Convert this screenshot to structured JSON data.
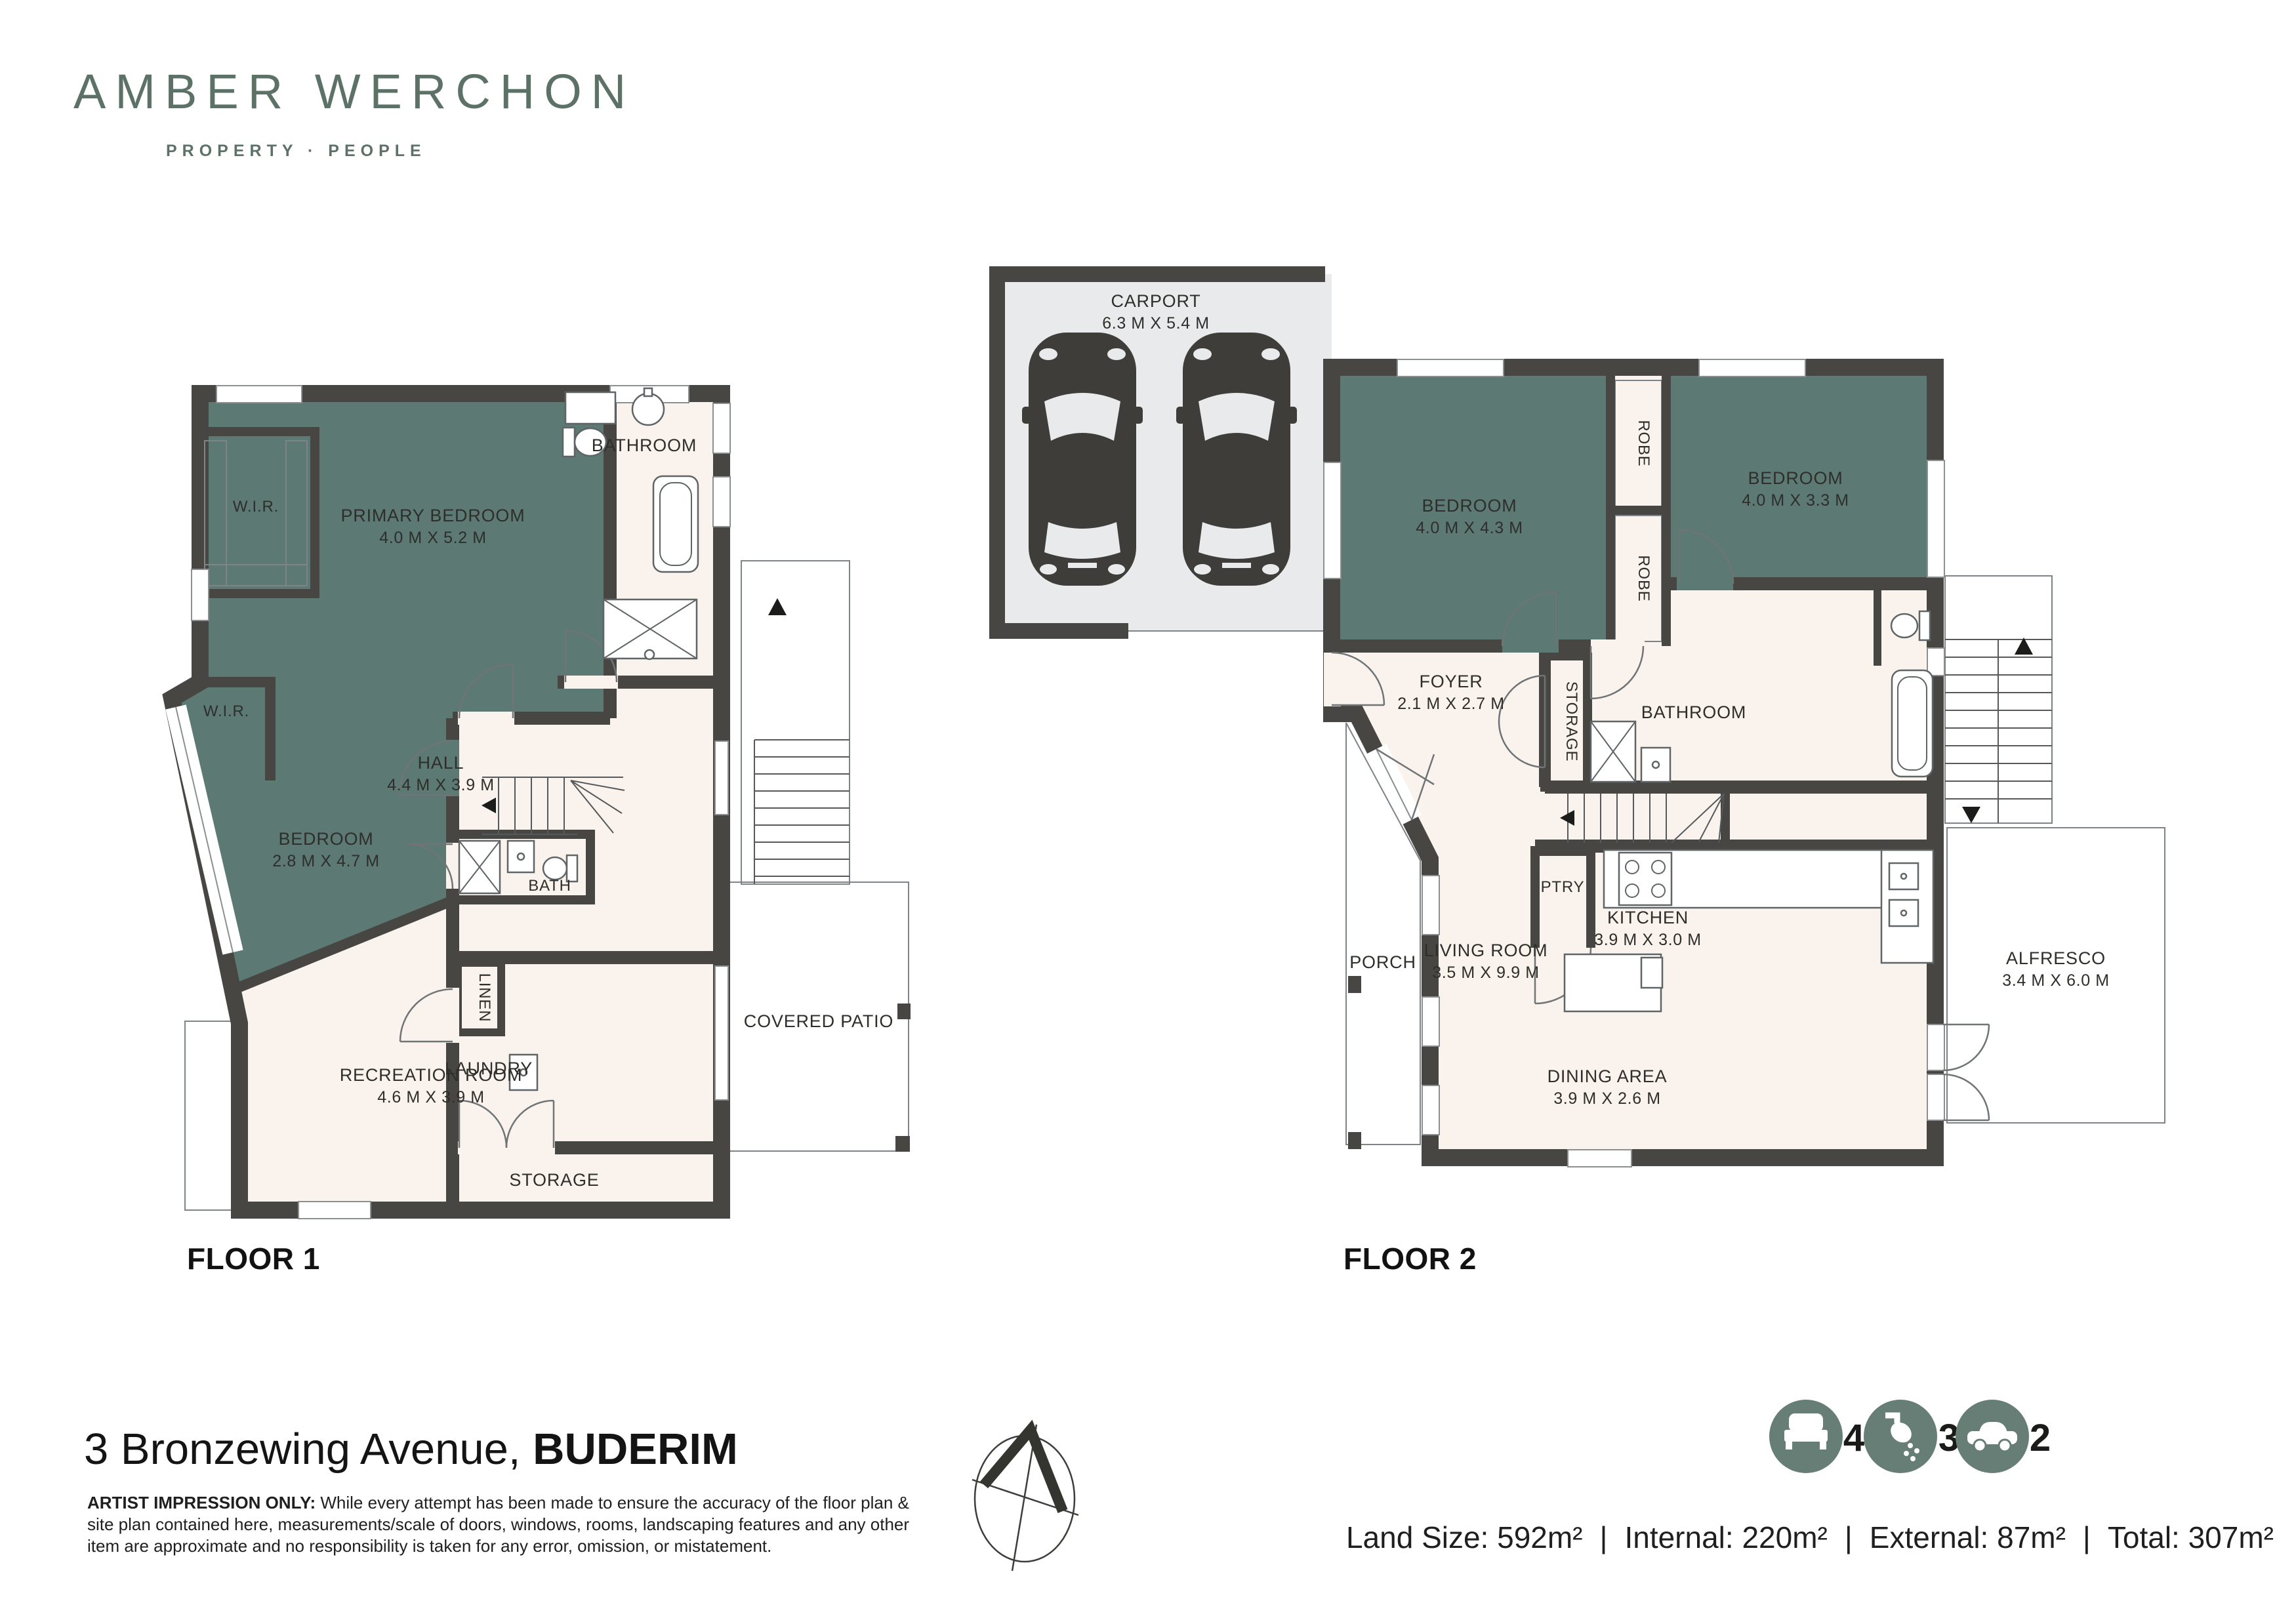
{
  "brand": {
    "name": "AMBER WERCHON",
    "tagline": "PROPERTY · PEOPLE"
  },
  "floor1": {
    "label": "FLOOR 1",
    "rooms": {
      "wir1": "W.I.R.",
      "wir2": "W.I.R.",
      "primary_bedroom": {
        "name": "PRIMARY BEDROOM",
        "dims": "4.0 M X 5.2 M"
      },
      "bathroom": "BATHROOM",
      "hall": {
        "name": "HALL",
        "dims": "4.4 M X 3.9 M"
      },
      "bedroom": {
        "name": "BEDROOM",
        "dims": "2.8 M X 4.7 M"
      },
      "bath": "BATH",
      "linen": "LINEN",
      "laundry": "LAUNDRY",
      "storage": "STORAGE",
      "recreation": {
        "name": "RECREATION ROOM",
        "dims": "4.6 M X 3.9 M"
      },
      "covered_patio": "COVERED PATIO"
    }
  },
  "floor2": {
    "label": "FLOOR 2",
    "rooms": {
      "carport": {
        "name": "CARPORT",
        "dims": "6.3 M X 5.4 M"
      },
      "bedroom_left": {
        "name": "BEDROOM",
        "dims": "4.0 M X 4.3 M"
      },
      "bedroom_right": {
        "name": "BEDROOM",
        "dims": "4.0 M X 3.3 M"
      },
      "robe1": "ROBE",
      "robe2": "ROBE",
      "foyer": {
        "name": "FOYER",
        "dims": "2.1 M X 2.7 M"
      },
      "storage": "STORAGE",
      "bathroom": "BATHROOM",
      "ptry": "PTRY",
      "kitchen": {
        "name": "KITCHEN",
        "dims": "3.9 M X 3.0 M"
      },
      "living": {
        "name": "LIVING ROOM",
        "dims": "3.5 M X 9.9 M"
      },
      "dining": {
        "name": "DINING AREA",
        "dims": "3.9 M X 2.6 M"
      },
      "porch": "PORCH",
      "alfresco": {
        "name": "ALFRESCO",
        "dims": "3.4 M X 6.0 M"
      }
    }
  },
  "footer": {
    "address_main": "3 Bronzewing Avenue, ",
    "address_suburb": "BUDERIM",
    "disclaimer": {
      "bold": "ARTIST IMPRESSION ONLY:",
      "line1_rest": " While every attempt has been made to ensure the accuracy of the floor plan &",
      "line2": "site plan contained here, measurements/scale of doors, windows, rooms, landscaping features and any other",
      "line3": "item are approximate and no responsibility is taken for any error, omission, or mistatement."
    },
    "stats": {
      "beds": "4",
      "baths": "3",
      "cars": "2"
    },
    "areas": {
      "land": "Land Size: 592m²",
      "internal": "Internal: 220m²",
      "external": "External: 87m²",
      "total": "Total: 307m²",
      "separator": "|"
    }
  },
  "colors": {
    "bedroom_teal": "#5c7973",
    "wall": "#474642",
    "interior_floor": "#faf2ec",
    "outdoor_gray": "#e8eaeb",
    "brand_sage": "#5c7267",
    "icon_sage": "#667e76"
  }
}
